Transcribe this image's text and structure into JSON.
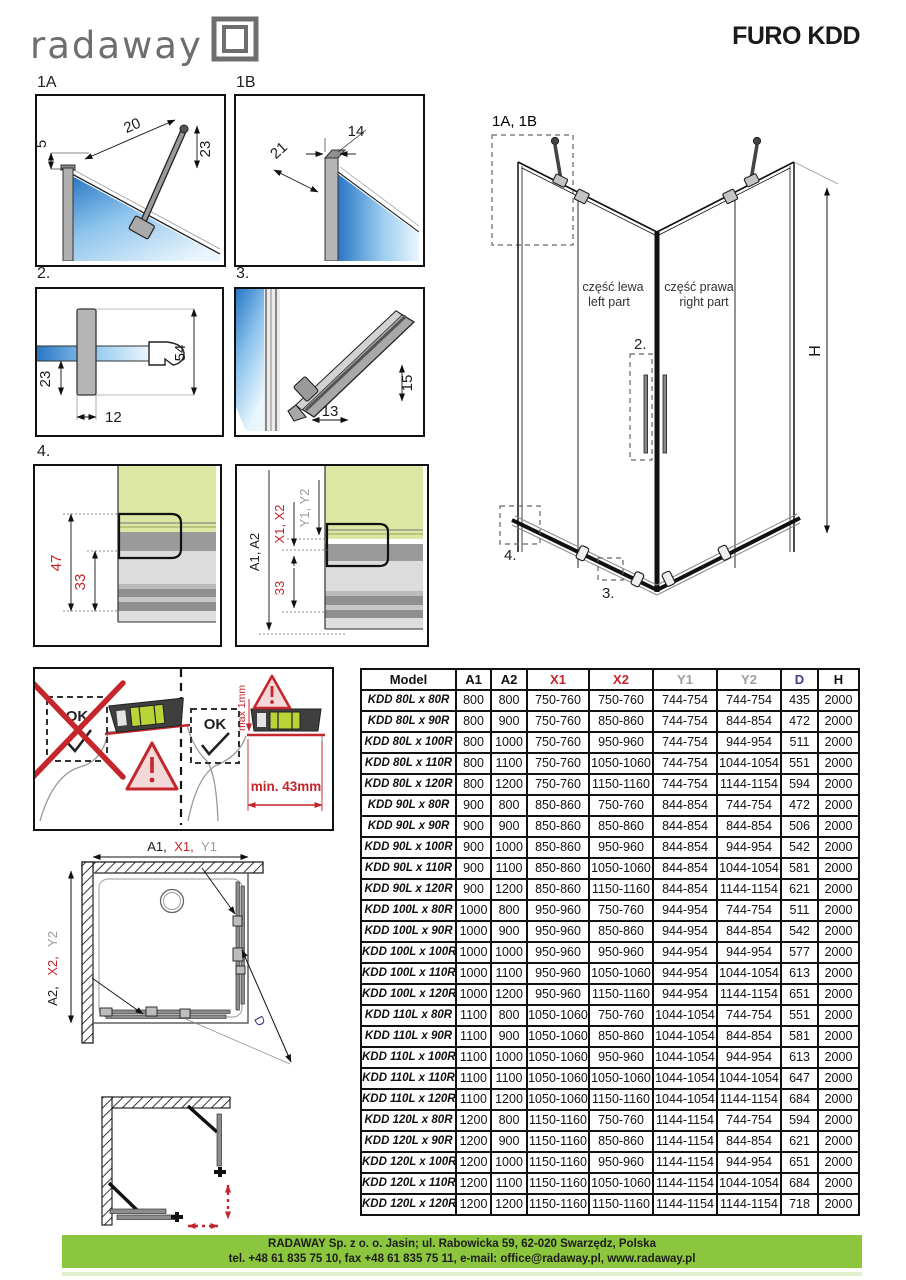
{
  "header": {
    "logo_text": "radaway",
    "title": "FURO KDD"
  },
  "details": {
    "d1a": {
      "label": "1A",
      "dim_top": "20",
      "dim_right": "23",
      "dim_left": "5"
    },
    "d1b": {
      "label": "1B",
      "dim_top": "14",
      "dim_diag": "21"
    },
    "d2": {
      "label": "2.",
      "dim_right": "54",
      "dim_left": "23",
      "dim_bottom": "12"
    },
    "d3": {
      "label": "3.",
      "dim_right": "15",
      "dim_bottom": "13"
    },
    "d4": {
      "label": "4.",
      "left": {
        "dim_outer": "47",
        "dim_inner": "33"
      },
      "right": {
        "dim_a": "A1, A2",
        "dim_x": "X1, X2",
        "dim_y": "Y1, Y2",
        "dim_inner": "33"
      }
    }
  },
  "isometric": {
    "callout_1ab": "1A, 1B",
    "callout_2": "2.",
    "callout_3": "3.",
    "callout_4": "4.",
    "left_part_line1": "część lewa",
    "left_part_line2": "left part",
    "right_part_line1": "część prawa",
    "right_part_line2": "right part",
    "height_label": "H"
  },
  "installation": {
    "not_ok_label": "OK",
    "ok_label": "OK",
    "max_gap": "max 1mm",
    "min_width": "min. 43mm",
    "warning_glyph": "!"
  },
  "plan": {
    "top_dim_a": "A1,",
    "top_dim_x": "X1,",
    "top_dim_y": "Y1",
    "left_dim_a": "A2,",
    "left_dim_x": "X2,",
    "left_dim_y": "Y2",
    "diag_dim": "D"
  },
  "table": {
    "headers": [
      "Model",
      "A1",
      "A2",
      "X1",
      "X2",
      "Y1",
      "Y2",
      "D",
      "H"
    ],
    "rows": [
      [
        "KDD 80L x 80R",
        "800",
        "800",
        "750-760",
        "750-760",
        "744-754",
        "744-754",
        "435",
        "2000"
      ],
      [
        "KDD 80L x 90R",
        "800",
        "900",
        "750-760",
        "850-860",
        "744-754",
        "844-854",
        "472",
        "2000"
      ],
      [
        "KDD 80L x 100R",
        "800",
        "1000",
        "750-760",
        "950-960",
        "744-754",
        "944-954",
        "511",
        "2000"
      ],
      [
        "KDD 80L x 110R",
        "800",
        "1100",
        "750-760",
        "1050-1060",
        "744-754",
        "1044-1054",
        "551",
        "2000"
      ],
      [
        "KDD 80L x 120R",
        "800",
        "1200",
        "750-760",
        "1150-1160",
        "744-754",
        "1144-1154",
        "594",
        "2000"
      ],
      [
        "KDD 90L x 80R",
        "900",
        "800",
        "850-860",
        "750-760",
        "844-854",
        "744-754",
        "472",
        "2000"
      ],
      [
        "KDD 90L x 90R",
        "900",
        "900",
        "850-860",
        "850-860",
        "844-854",
        "844-854",
        "506",
        "2000"
      ],
      [
        "KDD 90L x 100R",
        "900",
        "1000",
        "850-860",
        "950-960",
        "844-854",
        "944-954",
        "542",
        "2000"
      ],
      [
        "KDD 90L x 110R",
        "900",
        "1100",
        "850-860",
        "1050-1060",
        "844-854",
        "1044-1054",
        "581",
        "2000"
      ],
      [
        "KDD 90L x 120R",
        "900",
        "1200",
        "850-860",
        "1150-1160",
        "844-854",
        "1144-1154",
        "621",
        "2000"
      ],
      [
        "KDD 100L x 80R",
        "1000",
        "800",
        "950-960",
        "750-760",
        "944-954",
        "744-754",
        "511",
        "2000"
      ],
      [
        "KDD 100L x 90R",
        "1000",
        "900",
        "950-960",
        "850-860",
        "944-954",
        "844-854",
        "542",
        "2000"
      ],
      [
        "KDD 100L x 100R",
        "1000",
        "1000",
        "950-960",
        "950-960",
        "944-954",
        "944-954",
        "577",
        "2000"
      ],
      [
        "KDD 100L x 110R",
        "1000",
        "1100",
        "950-960",
        "1050-1060",
        "944-954",
        "1044-1054",
        "613",
        "2000"
      ],
      [
        "KDD 100L x 120R",
        "1000",
        "1200",
        "950-960",
        "1150-1160",
        "944-954",
        "1144-1154",
        "651",
        "2000"
      ],
      [
        "KDD 110L x 80R",
        "1100",
        "800",
        "1050-1060",
        "750-760",
        "1044-1054",
        "744-754",
        "551",
        "2000"
      ],
      [
        "KDD 110L x 90R",
        "1100",
        "900",
        "1050-1060",
        "850-860",
        "1044-1054",
        "844-854",
        "581",
        "2000"
      ],
      [
        "KDD 110L x 100R",
        "1100",
        "1000",
        "1050-1060",
        "950-960",
        "1044-1054",
        "944-954",
        "613",
        "2000"
      ],
      [
        "KDD 110L x 110R",
        "1100",
        "1100",
        "1050-1060",
        "1050-1060",
        "1044-1054",
        "1044-1054",
        "647",
        "2000"
      ],
      [
        "KDD 110L x 120R",
        "1100",
        "1200",
        "1050-1060",
        "1150-1160",
        "1044-1054",
        "1144-1154",
        "684",
        "2000"
      ],
      [
        "KDD 120L x 80R",
        "1200",
        "800",
        "1150-1160",
        "750-760",
        "1144-1154",
        "744-754",
        "594",
        "2000"
      ],
      [
        "KDD 120L x 90R",
        "1200",
        "900",
        "1150-1160",
        "850-860",
        "1144-1154",
        "844-854",
        "621",
        "2000"
      ],
      [
        "KDD 120L x 100R",
        "1200",
        "1000",
        "1150-1160",
        "950-960",
        "1144-1154",
        "944-954",
        "651",
        "2000"
      ],
      [
        "KDD 120L x 110R",
        "1200",
        "1100",
        "1150-1160",
        "1050-1060",
        "1144-1154",
        "1044-1054",
        "684",
        "2000"
      ],
      [
        "KDD 120L x 120R",
        "1200",
        "1200",
        "1150-1160",
        "1150-1160",
        "1144-1154",
        "1144-1154",
        "718",
        "2000"
      ]
    ]
  },
  "footer": {
    "line1": "RADAWAY Sp. z o. o. Jasin; ul. Rabowicka 59, 62-020 Swarzędz, Polska",
    "line2": "tel. +48 61 835 75 10, fax +48 61 835 75 11, e-mail: office@radaway.pl, www.radaway.pl"
  },
  "colors": {
    "accent_red": "#c4262c",
    "dim_gray": "#9d9d9c",
    "diag_navy": "#3e3d85",
    "footer_green": "#8cc63f",
    "section_green": "#dbe7a3",
    "glass_blue": "#2a77c6"
  }
}
